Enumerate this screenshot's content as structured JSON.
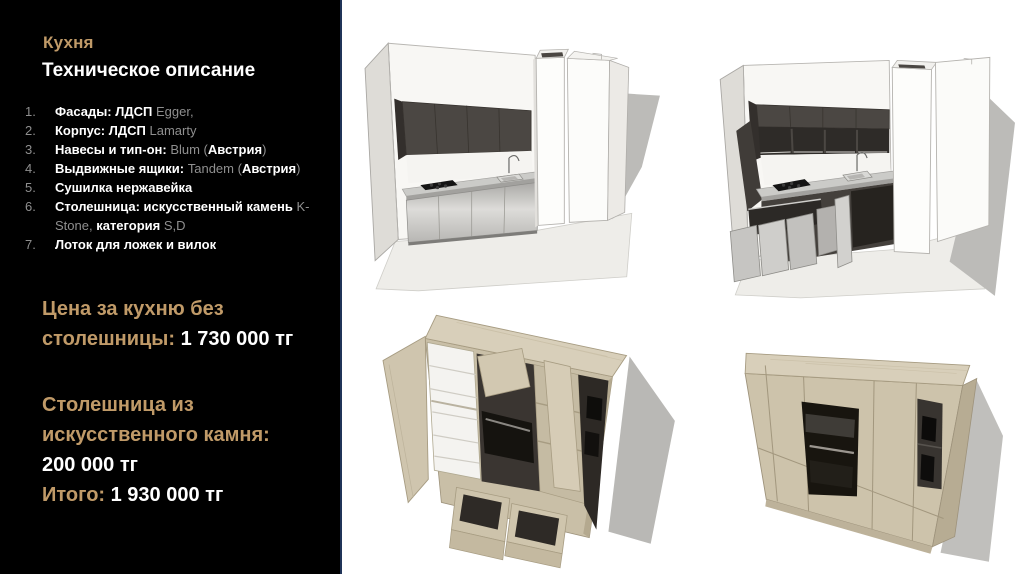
{
  "panel": {
    "title": "Кухня",
    "subtitle": "Техническое описание",
    "specs": [
      {
        "num": "1.",
        "b1": "Фасады: ЛДСП ",
        "g1": "Egger,"
      },
      {
        "num": "2.",
        "b1": "Корпус: ЛДСП ",
        "g1": "Lamarty"
      },
      {
        "num": "3.",
        "b1": "Навесы и тип-он: ",
        "g1": "Blum (",
        "b2": "Австрия",
        "g2": ")"
      },
      {
        "num": "4.",
        "b1": "Выдвижные ящики: ",
        "g1": "Tandem (",
        "b2": "Австрия",
        "g2": ")"
      },
      {
        "num": "5.",
        "b1": "Сушилка нержавейка"
      },
      {
        "num": "6.",
        "b1": "Столешница: искусственный камень ",
        "g1": "K-Stone,",
        "b2": " категория ",
        "g2": "S,D"
      },
      {
        "num": "7.",
        "b1": "Лоток для ложек и вилок"
      }
    ],
    "price_kitchen_label": "Цена за кухню без столешницы: ",
    "price_kitchen_value": "1 730 000 тг",
    "price_countertop_label": "Столешница из искусственного камня: ",
    "price_countertop_value": "200 000 тг",
    "total_label": "Итого: ",
    "total_value": "1 930 000 тг"
  },
  "colors": {
    "accent_gold": "#c09a68",
    "text_white": "#ffffff",
    "text_muted": "#8f8f8f",
    "panel_background": "#000000",
    "panel_border": "#203458",
    "canvas_background": "#ffffff",
    "cabinet_dark": "#4b4743",
    "cabinet_wood": "#cdc3ab",
    "shadow_gray": "#bcbbb8"
  }
}
